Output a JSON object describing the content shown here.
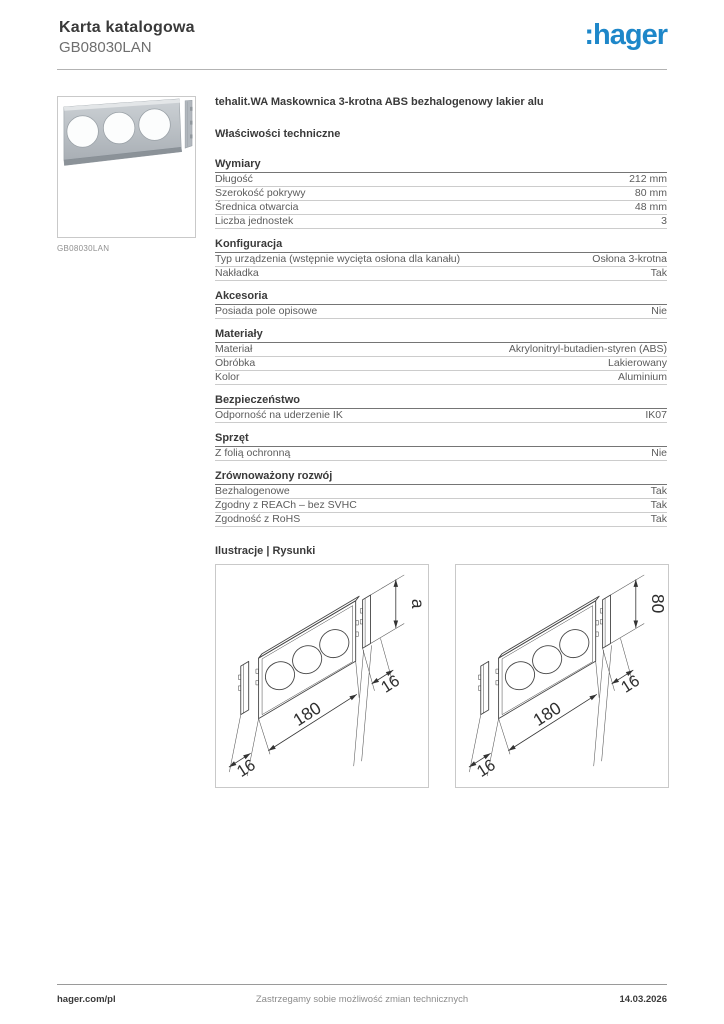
{
  "header": {
    "doc_type": "Karta katalogowa",
    "product_code": "GB08030LAN",
    "logo_text": ":hager",
    "logo_color": "#1e87c9"
  },
  "product_image": {
    "caption": "GB08030LAN"
  },
  "product_title": "tehalit.WA Maskownica 3-krotna ABS bezhalogenowy lakier alu",
  "properties_heading": "Właściwości techniczne",
  "spec_groups": [
    {
      "title": "Wymiary",
      "rows": [
        {
          "label": "Długość",
          "value": "212 mm"
        },
        {
          "label": "Szerokość pokrywy",
          "value": "80 mm"
        },
        {
          "label": "Średnica otwarcia",
          "value": "48 mm"
        },
        {
          "label": "Liczba jednostek",
          "value": "3"
        }
      ]
    },
    {
      "title": "Konfiguracja",
      "rows": [
        {
          "label": "Typ urządzenia (wstępnie wycięta osłona dla kanału)",
          "value": "Osłona 3-krotna"
        },
        {
          "label": "Nakładka",
          "value": "Tak"
        }
      ]
    },
    {
      "title": "Akcesoria",
      "rows": [
        {
          "label": "Posiada pole opisowe",
          "value": "Nie"
        }
      ]
    },
    {
      "title": "Materiały",
      "rows": [
        {
          "label": "Materiał",
          "value": "Akrylonitryl-butadien-styren (ABS)"
        },
        {
          "label": "Obróbka",
          "value": "Lakierowany"
        },
        {
          "label": "Kolor",
          "value": "Aluminium"
        }
      ]
    },
    {
      "title": "Bezpieczeństwo",
      "rows": [
        {
          "label": "Odporność na uderzenie IK",
          "value": "IK07"
        }
      ]
    },
    {
      "title": "Sprzęt",
      "rows": [
        {
          "label": "Z folią ochronną",
          "value": "Nie"
        }
      ]
    },
    {
      "title": "Zrównoważony rozwój",
      "rows": [
        {
          "label": "Bezhalogenowe",
          "value": "Tak"
        },
        {
          "label": "Zgodny z REACh – bez SVHC",
          "value": "Tak"
        },
        {
          "label": "Zgodność z RoHS",
          "value": "Tak"
        }
      ]
    }
  ],
  "illustrations": {
    "heading": "Ilustracje | Rysunki",
    "drawings": [
      {
        "dim_length": "180",
        "dim_side_left": "16",
        "dim_side_right": "16",
        "dim_height": "a"
      },
      {
        "dim_length": "180",
        "dim_side_left": "16",
        "dim_side_right": "16",
        "dim_height": "80"
      }
    ]
  },
  "footer": {
    "left": "hager.com/pl",
    "center": "Zastrzegamy sobie możliwość zmian technicznych",
    "right": "14.03.2026"
  }
}
